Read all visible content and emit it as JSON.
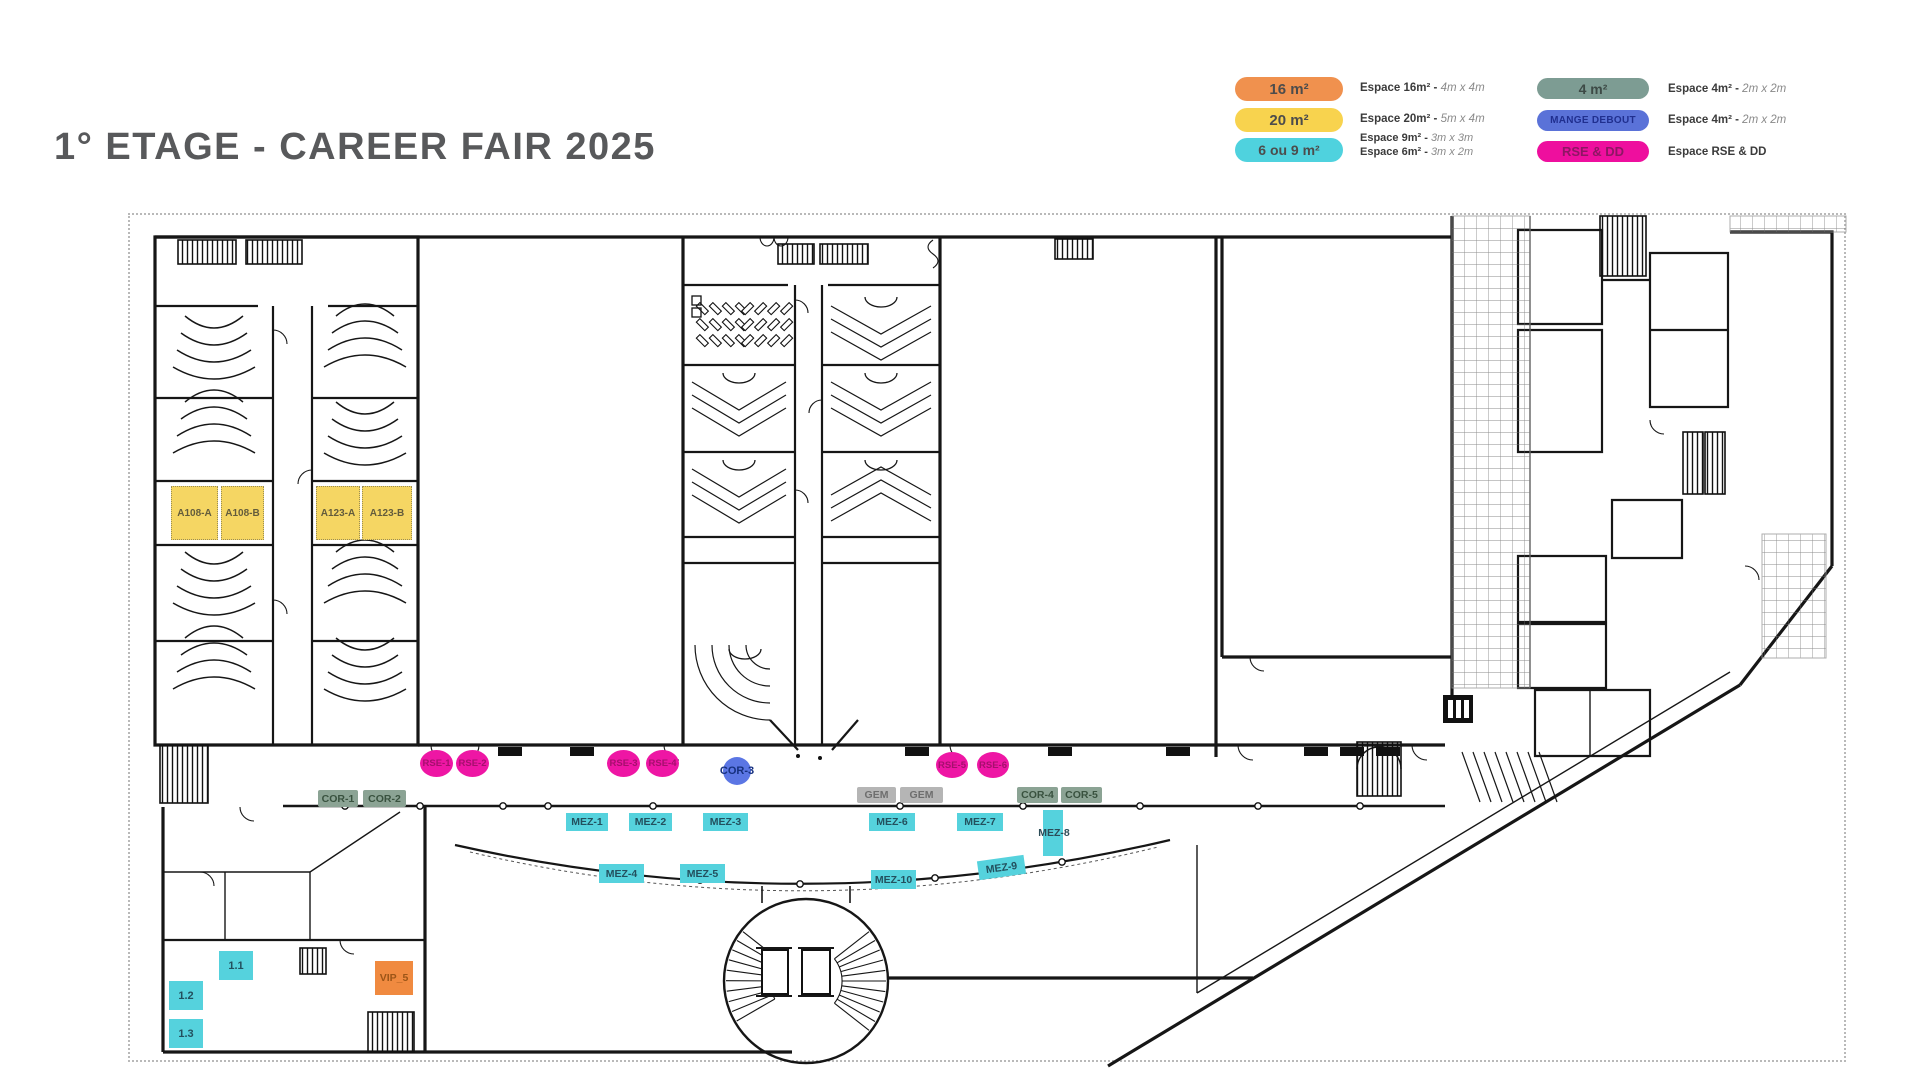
{
  "page": {
    "title": "1° ETAGE - CAREER FAIR 2025"
  },
  "colors": {
    "title": "#58595b",
    "orange_16m2": "#f0914e",
    "yellow_20m2": "#f8d34e",
    "cyan_6_9m2": "#4fd2de",
    "sage_4m2": "#7d9c93",
    "blue_mange_debout": "#5a72d8",
    "magenta_rse_dd": "#ee0f9e",
    "booth_orange_vip": "#f08a40",
    "booth_gray_gem": "#b5b5b5",
    "wall": "#161616"
  },
  "legend": {
    "pills": [
      {
        "label": "16 m²"
      },
      {
        "label": "20 m²"
      },
      {
        "label": "6 ou 9 m²"
      },
      {
        "label": "4 m²"
      },
      {
        "label": "MANGE DEBOUT"
      },
      {
        "label": "RSE & DD"
      }
    ],
    "descs": [
      {
        "bold": "Espace 16m²",
        "sep": " - ",
        "italic": "4m x 4m"
      },
      {
        "bold": "Espace 20m²",
        "sep": " - ",
        "italic": "5m x 4m"
      },
      {
        "bold": "Espace 9m²",
        "sep": " - ",
        "italic": "3m x 3m"
      },
      {
        "bold": "Espace 6m²",
        "sep": " - ",
        "italic": "3m x 2m"
      },
      {
        "bold": "Espace 4m²",
        "sep": " - ",
        "italic": "2m x 2m"
      },
      {
        "bold": "Espace 4m²",
        "sep": " - ",
        "italic": "2m x 2m"
      },
      {
        "bold": "Espace RSE & DD",
        "sep": "",
        "italic": ""
      }
    ]
  },
  "booths": [
    {
      "label": "A108-A",
      "type": "20m2"
    },
    {
      "label": "A108-B",
      "type": "20m2"
    },
    {
      "label": "A123-A",
      "type": "20m2"
    },
    {
      "label": "A123-B",
      "type": "20m2"
    },
    {
      "label": "RSE-1",
      "type": "rse-dd"
    },
    {
      "label": "RSE-2",
      "type": "rse-dd"
    },
    {
      "label": "RSE-3",
      "type": "rse-dd"
    },
    {
      "label": "RSE-4",
      "type": "rse-dd"
    },
    {
      "label": "RSE-5",
      "type": "rse-dd"
    },
    {
      "label": "RSE-6",
      "type": "rse-dd"
    },
    {
      "label": "COR-3",
      "type": "mange-debout"
    },
    {
      "label": "COR-1",
      "type": "4m2"
    },
    {
      "label": "COR-2",
      "type": "4m2"
    },
    {
      "label": "COR-4",
      "type": "4m2"
    },
    {
      "label": "COR-5",
      "type": "4m2"
    },
    {
      "label": "GEM",
      "type": "gem"
    },
    {
      "label": "GEM",
      "type": "gem"
    },
    {
      "label": "MEZ-1",
      "type": "6-9m2"
    },
    {
      "label": "MEZ-2",
      "type": "6-9m2"
    },
    {
      "label": "MEZ-3",
      "type": "6-9m2"
    },
    {
      "label": "MEZ-4",
      "type": "6-9m2"
    },
    {
      "label": "MEZ-5",
      "type": "6-9m2"
    },
    {
      "label": "MEZ-6",
      "type": "6-9m2"
    },
    {
      "label": "MEZ-7",
      "type": "6-9m2"
    },
    {
      "label": "MEZ-8",
      "type": "6-9m2"
    },
    {
      "label": "MEZ-9",
      "type": "6-9m2"
    },
    {
      "label": "MEZ-10",
      "type": "6-9m2"
    },
    {
      "label": "1.1",
      "type": "6-9m2"
    },
    {
      "label": "1.2",
      "type": "6-9m2"
    },
    {
      "label": "1.3",
      "type": "6-9m2"
    },
    {
      "label": "VIP_5",
      "type": "16m2"
    }
  ]
}
